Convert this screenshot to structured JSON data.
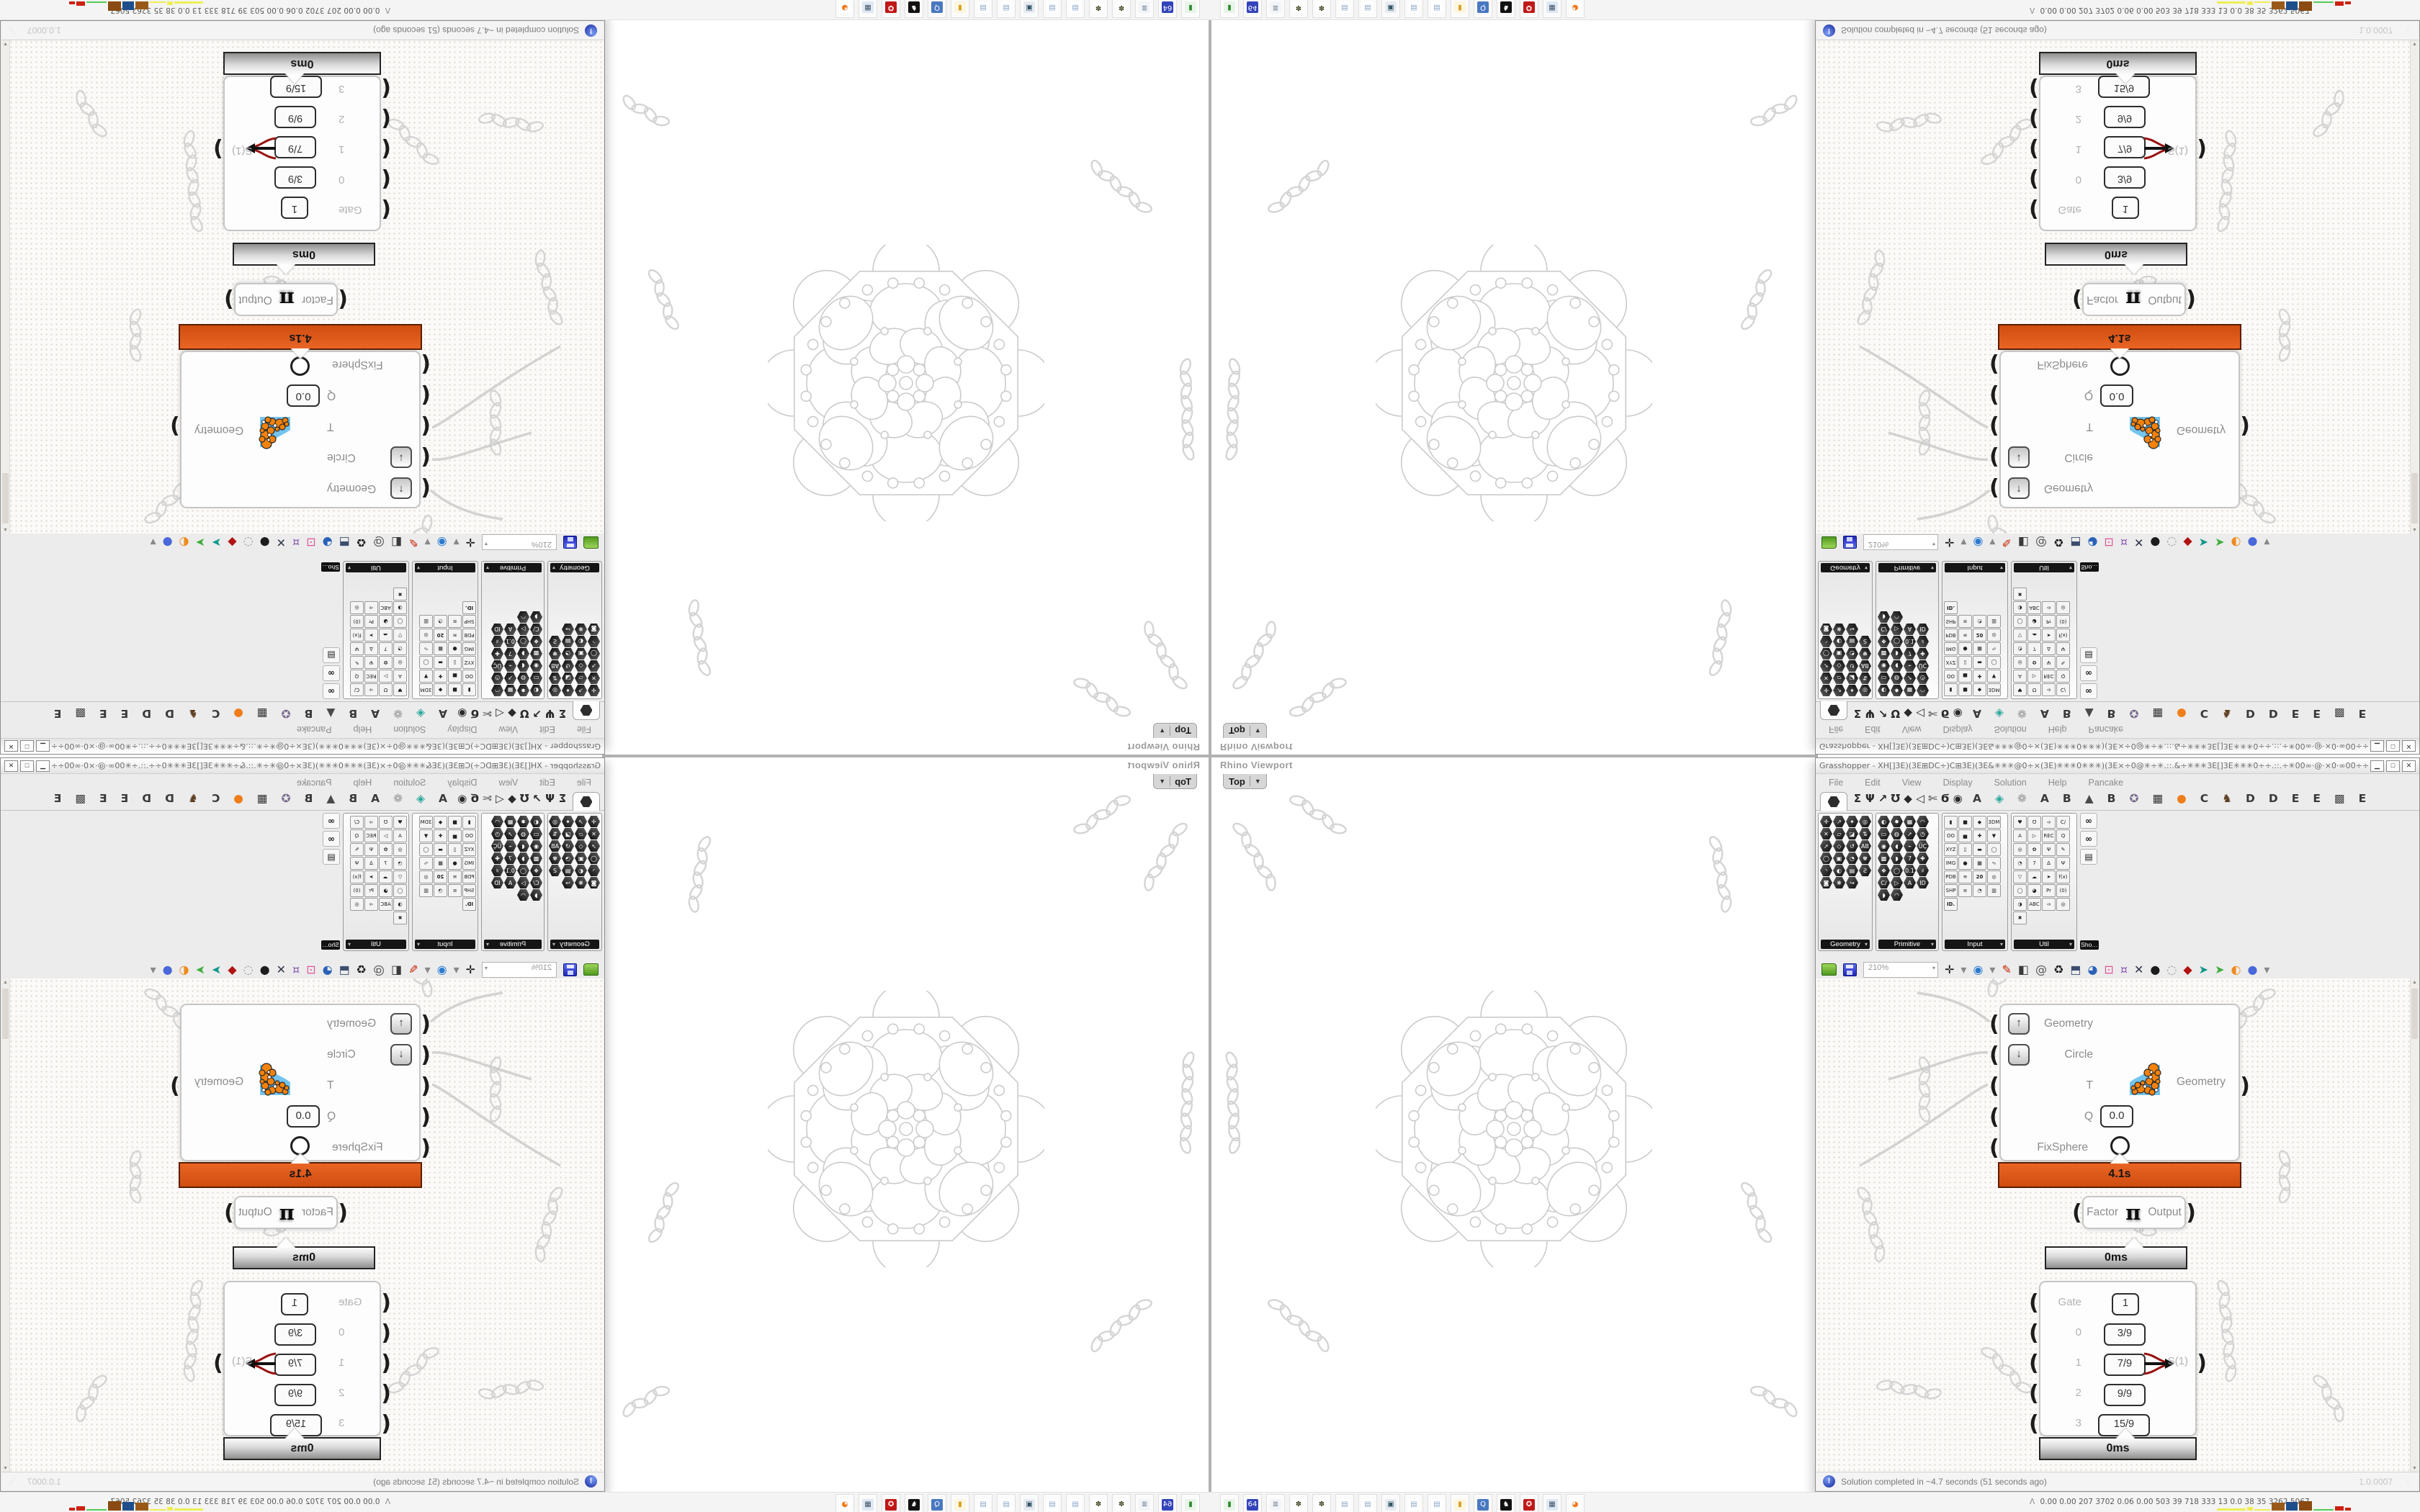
{
  "desktop": {
    "taskbar": {
      "icons": [
        {
          "name": "green-drive-icon",
          "g": "▮",
          "c": "#2d8a2d",
          "bg": "#eaf5ea"
        },
        {
          "name": "floppy-64-icon",
          "g": "64",
          "c": "#ffffff",
          "bg": "#3344bb"
        },
        {
          "name": "scroll-icon",
          "g": "≣",
          "c": "#667788",
          "bg": "#f2f4f8"
        },
        {
          "name": "seed-icon",
          "g": "✽",
          "c": "#4a4a28",
          "bg": "#ffffff"
        },
        {
          "name": "seed-icon",
          "g": "✽",
          "c": "#4a4a28",
          "bg": "#ffffff"
        },
        {
          "name": "notepad-icon",
          "g": "▤",
          "c": "#89a8c8",
          "bg": "#ffffff"
        },
        {
          "name": "notepad-icon",
          "g": "▤",
          "c": "#89a8c8",
          "bg": "#ffffff"
        },
        {
          "name": "monitor-icon",
          "g": "▣",
          "c": "#335566",
          "bg": "#e8ecf2"
        },
        {
          "name": "notepad-icon",
          "g": "▤",
          "c": "#89a8c8",
          "bg": "#ffffff"
        },
        {
          "name": "notepad-icon",
          "g": "▤",
          "c": "#89a8c8",
          "bg": "#ffffff"
        },
        {
          "name": "folder-icon",
          "g": "▮",
          "c": "#d8a020",
          "bg": "#fdf6e0"
        },
        {
          "name": "search-display-icon",
          "g": "Q",
          "c": "#ffffff",
          "bg": "#4a78c0"
        },
        {
          "name": "penguin-icon",
          "g": "♞",
          "c": "#ffffff",
          "bg": "#111111"
        },
        {
          "name": "red-emblem-icon",
          "g": "✪",
          "c": "#ffffff",
          "bg": "#c01818"
        },
        {
          "name": "calculator-icon",
          "g": "▦",
          "c": "#445566",
          "bg": "#dfe8f5"
        },
        {
          "name": "firefox-icon",
          "g": "◕",
          "c": "#f07818",
          "bg": "#ffffff"
        }
      ],
      "monitor_prefix": "Λ",
      "monitor_values": "0.00 0.00  207  3702 0.06 0.00  503   39   718  333   13   0.0   38   35  3262 5067",
      "monitor_bars": [
        {
          "w": 40,
          "h": 3,
          "c": "#eeee55"
        },
        {
          "w": 8,
          "h": 5,
          "c": "#eeee55"
        },
        {
          "w": 22,
          "h": 2,
          "c": "#eeee55"
        },
        {
          "w": 18,
          "h": 11,
          "c": "#9a5a17"
        },
        {
          "w": 16,
          "h": 12,
          "c": "#1f4e8c"
        },
        {
          "w": 18,
          "h": 13,
          "c": "#8a4a12"
        },
        {
          "w": 28,
          "h": 2,
          "c": "#55cc55"
        },
        {
          "w": 12,
          "h": 6,
          "c": "#cc2211"
        },
        {
          "w": 8,
          "h": 4,
          "c": "#cc2211"
        }
      ]
    }
  },
  "rhino": {
    "window_label": "Rhino Viewport",
    "viewport_tab": "Top",
    "tab_caret": "▼"
  },
  "grasshopper": {
    "title": "Grasshopper - XH[]3E)(3E⊞DC÷)C⊞3E)(3E&✳✳✳@0÷×(3E)✳✳✳0✳✳✳)(3E×÷0@✳÷✳.::.&÷✳✳✳3E[]3E✳✳✳0÷÷.::.÷✳00∞·@·×0·∞00÷÷&.::.&÷00∞·@·×0·∞00÷✳&✳✳✳@0÷×(3E)✳✳✳0✳✳...",
    "window_buttons": {
      "minimize": "▁",
      "maximize": "□",
      "close": "✕"
    },
    "menu": [
      "File",
      "Edit",
      "View",
      "Display",
      "Solution",
      "Help",
      "Pancake"
    ],
    "tab_glyphs": [
      {
        "g": "Σ"
      },
      {
        "g": "Ψ"
      },
      {
        "g": "↗"
      },
      {
        "g": "Ʊ"
      },
      {
        "g": "◆"
      },
      {
        "g": "◁"
      },
      {
        "g": "✄"
      },
      {
        "g": "Ϭ"
      },
      {
        "g": "◉"
      }
    ],
    "tab_letters": [
      {
        "g": "A"
      },
      {
        "g": "◈",
        "c": "#2aa79b"
      },
      {
        "g": "❁",
        "c": "#9a9a9a"
      },
      {
        "g": "A"
      },
      {
        "g": "B"
      },
      {
        "g": "▲",
        "c": "#4a4a4a"
      },
      {
        "g": "B"
      },
      {
        "g": "✪",
        "c": "#7a6a8a"
      },
      {
        "g": "▦",
        "c": "#333333"
      },
      {
        "g": "●",
        "c": "#ef7d1a"
      },
      {
        "g": "C"
      },
      {
        "g": "♞",
        "c": "#5c3d1f"
      },
      {
        "g": "D"
      },
      {
        "g": "D"
      },
      {
        "g": "E"
      },
      {
        "g": "E"
      },
      {
        "g": "▩",
        "c": "#444444"
      },
      {
        "g": "E"
      }
    ],
    "panels": [
      {
        "label": "Geometry",
        "default_style": "hex",
        "icons": [
          "✛",
          "↗",
          "✦",
          "◎",
          "✕",
          "▱",
          "◪",
          "⇅",
          "➚",
          "◇",
          "↺",
          "AB",
          "◯",
          "▣",
          "◔",
          "✾",
          "◝",
          "◐",
          "▤",
          "Ƨ",
          "◙",
          "❋",
          "↪"
        ]
      },
      {
        "label": "Primitive",
        "default_style": "hex",
        "icons": [
          "◐",
          "✸",
          "▦",
          "◠",
          "▭",
          "◍",
          "➚",
          "◷",
          "◉",
          "◖",
          "⌁",
          "ÜÇ",
          "▩",
          "◗",
          "7",
          "✚",
          "❖",
          "◯",
          "0.1",
          "♯",
          "C/",
          "▷",
          "A",
          "ID",
          "◗",
          "◠"
        ]
      },
      {
        "label": "Input",
        "default_style": "sq",
        "icons": [
          {
            "g": "▮",
            "s": "dark"
          },
          {
            "g": "■",
            "s": "dark"
          },
          {
            "g": "◆",
            "s": "multi"
          },
          "3DM",
          "OO",
          {
            "g": "▅",
            "s": "yellow"
          },
          {
            "g": "✚",
            "s": "blue"
          },
          {
            "g": "▼",
            "s": "orange"
          },
          "XYZ",
          {
            "g": "▯",
            "s": "dark"
          },
          {
            "g": "▬",
            "s": "pink"
          },
          {
            "g": "◯",
            "s": "multi"
          },
          "IMG",
          {
            "g": "●",
            "s": "dark"
          },
          {
            "g": "▦",
            "s": "green"
          },
          {
            "g": "∿"
          },
          "PDB",
          {
            "g": "≋",
            "s": "dark"
          },
          {
            "g": "20",
            "s": "cal"
          },
          {
            "g": "◎"
          },
          "SHP",
          {
            "g": "≡"
          },
          {
            "g": "◔",
            "s": "dark"
          },
          {
            "g": "▥",
            "s": "multi"
          },
          {
            "g": "ID.",
            "s": "tag"
          }
        ]
      },
      {
        "label": "Util",
        "default_style": "sq",
        "icons": [
          {
            "g": "♥",
            "s": "red"
          },
          {
            "g": "Ʊ",
            "s": "dark"
          },
          {
            "g": "➩"
          },
          {
            "g": "C/",
            "s": "purple"
          },
          {
            "g": "A",
            "s": "purple"
          },
          {
            "g": "▷",
            "s": "red"
          },
          {
            "g": "REC",
            "s": "rec"
          },
          {
            "g": "Q"
          },
          {
            "g": "◎",
            "s": "purple"
          },
          {
            "g": "✿",
            "s": "pink"
          },
          {
            "g": "Ψ",
            "s": "multi"
          },
          {
            "g": "✎"
          },
          {
            "g": "◔"
          },
          {
            "g": "7",
            "s": "purple"
          },
          {
            "g": "Δ",
            "s": "pink"
          },
          {
            "g": "Ψ",
            "s": "dark"
          },
          {
            "g": "▽",
            "s": "blue"
          },
          {
            "g": "☁",
            "s": "cream"
          },
          {
            "g": "➤",
            "s": "purple"
          },
          {
            "g": "f(x)"
          },
          {
            "g": "◯"
          },
          {
            "g": "◕",
            "s": "dark"
          },
          {
            "g": "Pr",
            "s": "purple"
          },
          {
            "g": "(0)",
            "s": "purple"
          },
          {
            "g": "◑",
            "s": "multi"
          },
          {
            "g": "ABC"
          },
          {
            "g": "➩"
          },
          {
            "g": "◎",
            "s": "purple"
          },
          {
            "g": "✖",
            "s": "purple"
          }
        ]
      }
    ],
    "side_panel": {
      "label": "Sho…",
      "icons": [
        {
          "g": "∞",
          "n": "goggles-icon"
        },
        {
          "g": "∞",
          "n": "goggles-icon"
        },
        {
          "g": "▤",
          "n": "easel-icon"
        }
      ]
    },
    "canvas_toolbar": {
      "zoom_value": "210%",
      "icons": [
        {
          "t": "folder",
          "n": "open-file-icon"
        },
        {
          "t": "floppy",
          "n": "save-file-icon"
        },
        {
          "t": "combo",
          "n": "zoom-combo"
        },
        {
          "g": "✛",
          "c": "#111111",
          "n": "zoom-extents-icon"
        },
        {
          "g": "▾",
          "c": "#888888",
          "n": "dropdown-caret-icon"
        },
        {
          "g": "◉",
          "c": "#2b7bd0",
          "n": "preview-eye-icon"
        },
        {
          "g": "▾",
          "c": "#888888",
          "n": "dropdown-caret-icon"
        },
        {
          "g": "✎",
          "c": "#c42000",
          "n": "sketch-pen-icon"
        },
        {
          "g": "◧",
          "c": "#3a3a3a",
          "n": "exit-panel-icon"
        },
        {
          "g": "@",
          "c": "#555555",
          "n": "remote-icon"
        },
        {
          "g": "♻",
          "c": "#1a1a1a",
          "n": "gha-recycle-icon"
        },
        {
          "g": "⬒",
          "c": "#3c4d6e",
          "n": "screen-icon"
        },
        {
          "g": "◕",
          "c": "#2a62b8",
          "n": "finder-icon"
        },
        {
          "g": "⊡",
          "c": "#e0559a",
          "n": "help-box-icon"
        },
        {
          "g": "¤",
          "c": "#8a5ab5",
          "n": "lamp-icon"
        },
        {
          "g": "✕",
          "c": "#30364a",
          "n": "ribbon-icon"
        },
        {
          "g": "●",
          "c": "#1c1c1c",
          "n": "camera-icon"
        },
        {
          "g": "◌",
          "c": "#909090",
          "n": "rings-icon"
        },
        {
          "g": "◆",
          "c": "#b21212",
          "n": "gem-icon"
        },
        {
          "g": "➤",
          "c": "#12988a",
          "n": "pin-teal-icon"
        },
        {
          "g": "➤",
          "c": "#3fae3f",
          "n": "pin-green-icon"
        },
        {
          "g": "◐",
          "c": "#f08a1c",
          "n": "sphere-orange-icon"
        },
        {
          "g": "●",
          "c": "#4a68d8",
          "n": "sphere-blue-icon"
        },
        {
          "g": "▾",
          "c": "#888888",
          "n": "dropdown-caret-icon"
        }
      ]
    },
    "status": {
      "message": "Solution completed in ~4.7 seconds (51 seconds ago)",
      "version": "1.0.0007"
    }
  },
  "nodes": {
    "fixsphere": {
      "in1": "Geometry",
      "in2": "Circle",
      "in3": "T",
      "in4": "Q",
      "in4_value": "0.0",
      "in5": "FixSphere",
      "out": "Geometry",
      "time": "4.1s",
      "accent_color": "#d95513"
    },
    "pi": {
      "in": "Factor",
      "glyph": "π",
      "out": "Output",
      "time": "0ms"
    },
    "gate": {
      "l0": "Gate",
      "v0": "1",
      "l1": "0",
      "v1": "3/9",
      "l2": "1",
      "v2": "7/9",
      "l3": "2",
      "v3": "9/9",
      "l4": "3",
      "v4": "15/9",
      "out": "S(1)",
      "time": "0ms"
    }
  }
}
